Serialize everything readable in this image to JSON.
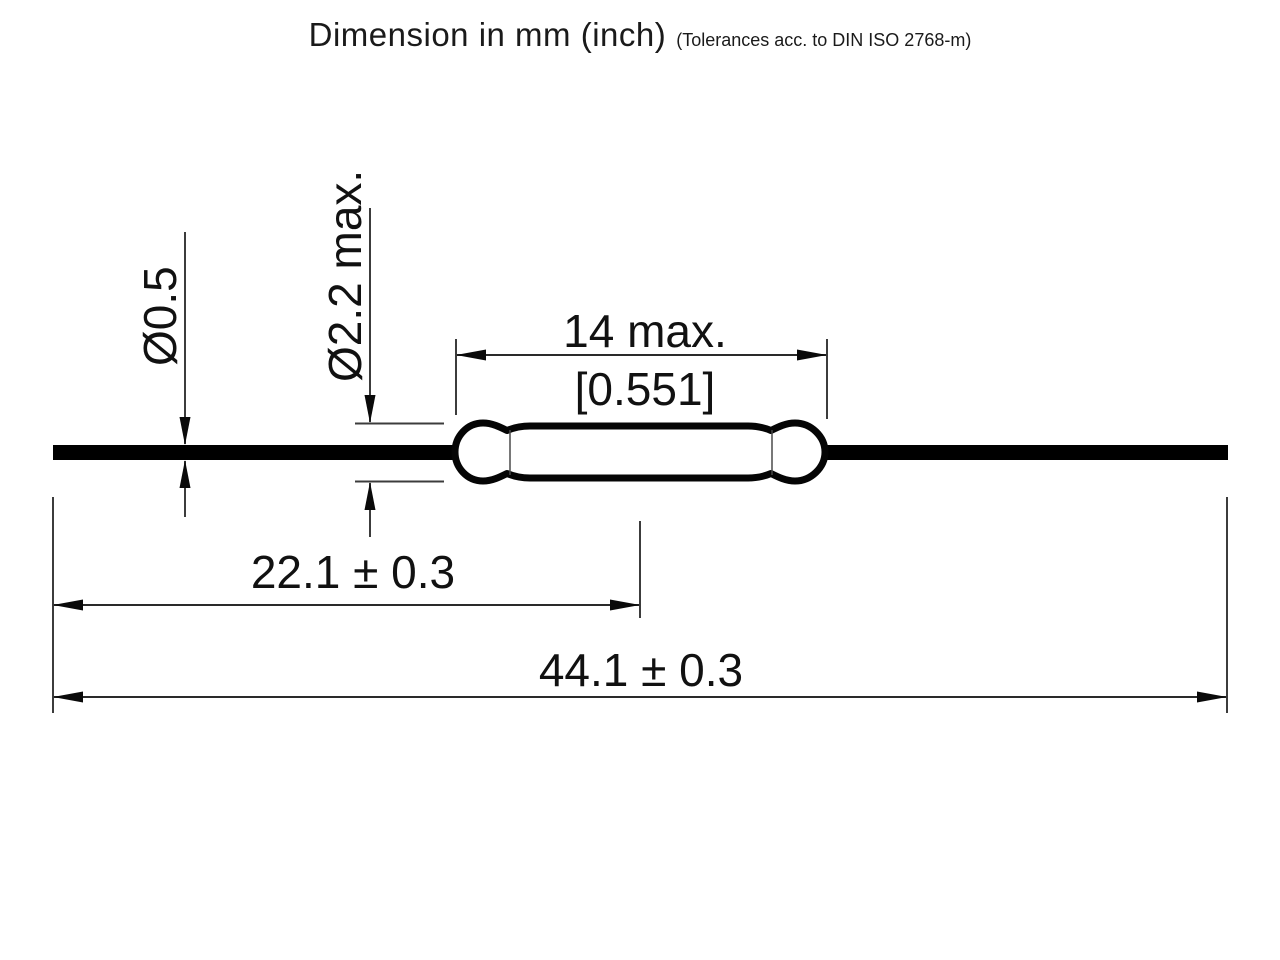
{
  "title": {
    "main": "Dimension in mm (inch)",
    "note": "(Tolerances acc. to DIN ISO 2768-m)"
  },
  "drawing": {
    "subject": "reed-switch-dimensional-outline",
    "dimensions": {
      "lead_diameter": "Ø0.5",
      "glass_diameter": "Ø2.2 max.",
      "glass_length": "14 max.",
      "glass_length_inch": "[0.551]",
      "lead_end_to_glass_center": "22.1 ± 0.3",
      "total_length": "44.1 ± 0.3"
    },
    "colors": {
      "ink": "#000000",
      "thin_line": "#3c3c3c",
      "background": "#ffffff"
    }
  }
}
